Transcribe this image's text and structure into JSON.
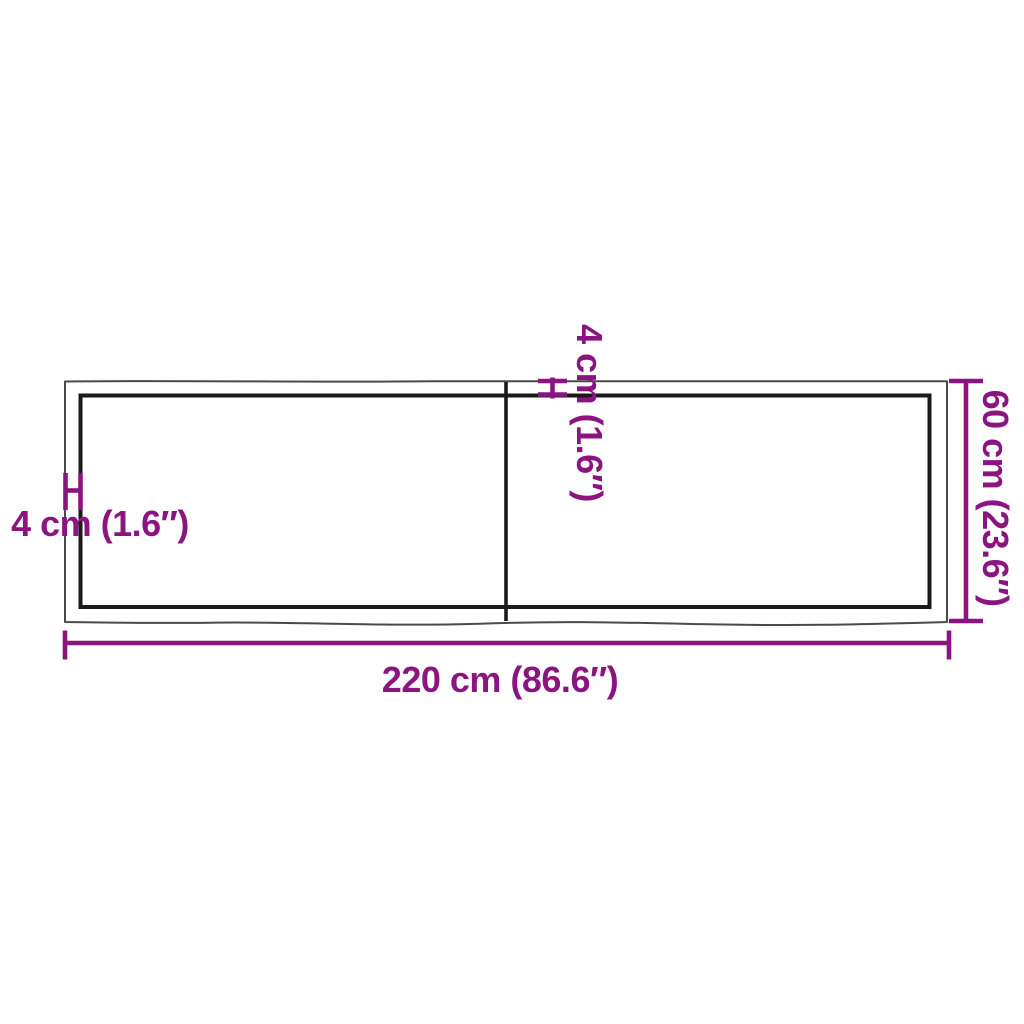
{
  "diagram": {
    "kind": "product-dimension-diagram",
    "labels": {
      "length": "220 cm (86.6″)",
      "depth": "60 cm (23.6″)",
      "thickness_left": "4 cm (1.6″)",
      "thickness_top": "4 cm (1.6″)"
    },
    "measurements": {
      "length_cm": 220,
      "length_in": 86.6,
      "depth_cm": 60,
      "depth_in": 23.6,
      "thickness_cm": 4,
      "thickness_in": 1.6
    },
    "colors": {
      "dimension_accent": "#8C1480",
      "outline_dark": "#1A1A1A",
      "outline_light": "#4A4A4A",
      "background": "#FFFFFF"
    }
  }
}
